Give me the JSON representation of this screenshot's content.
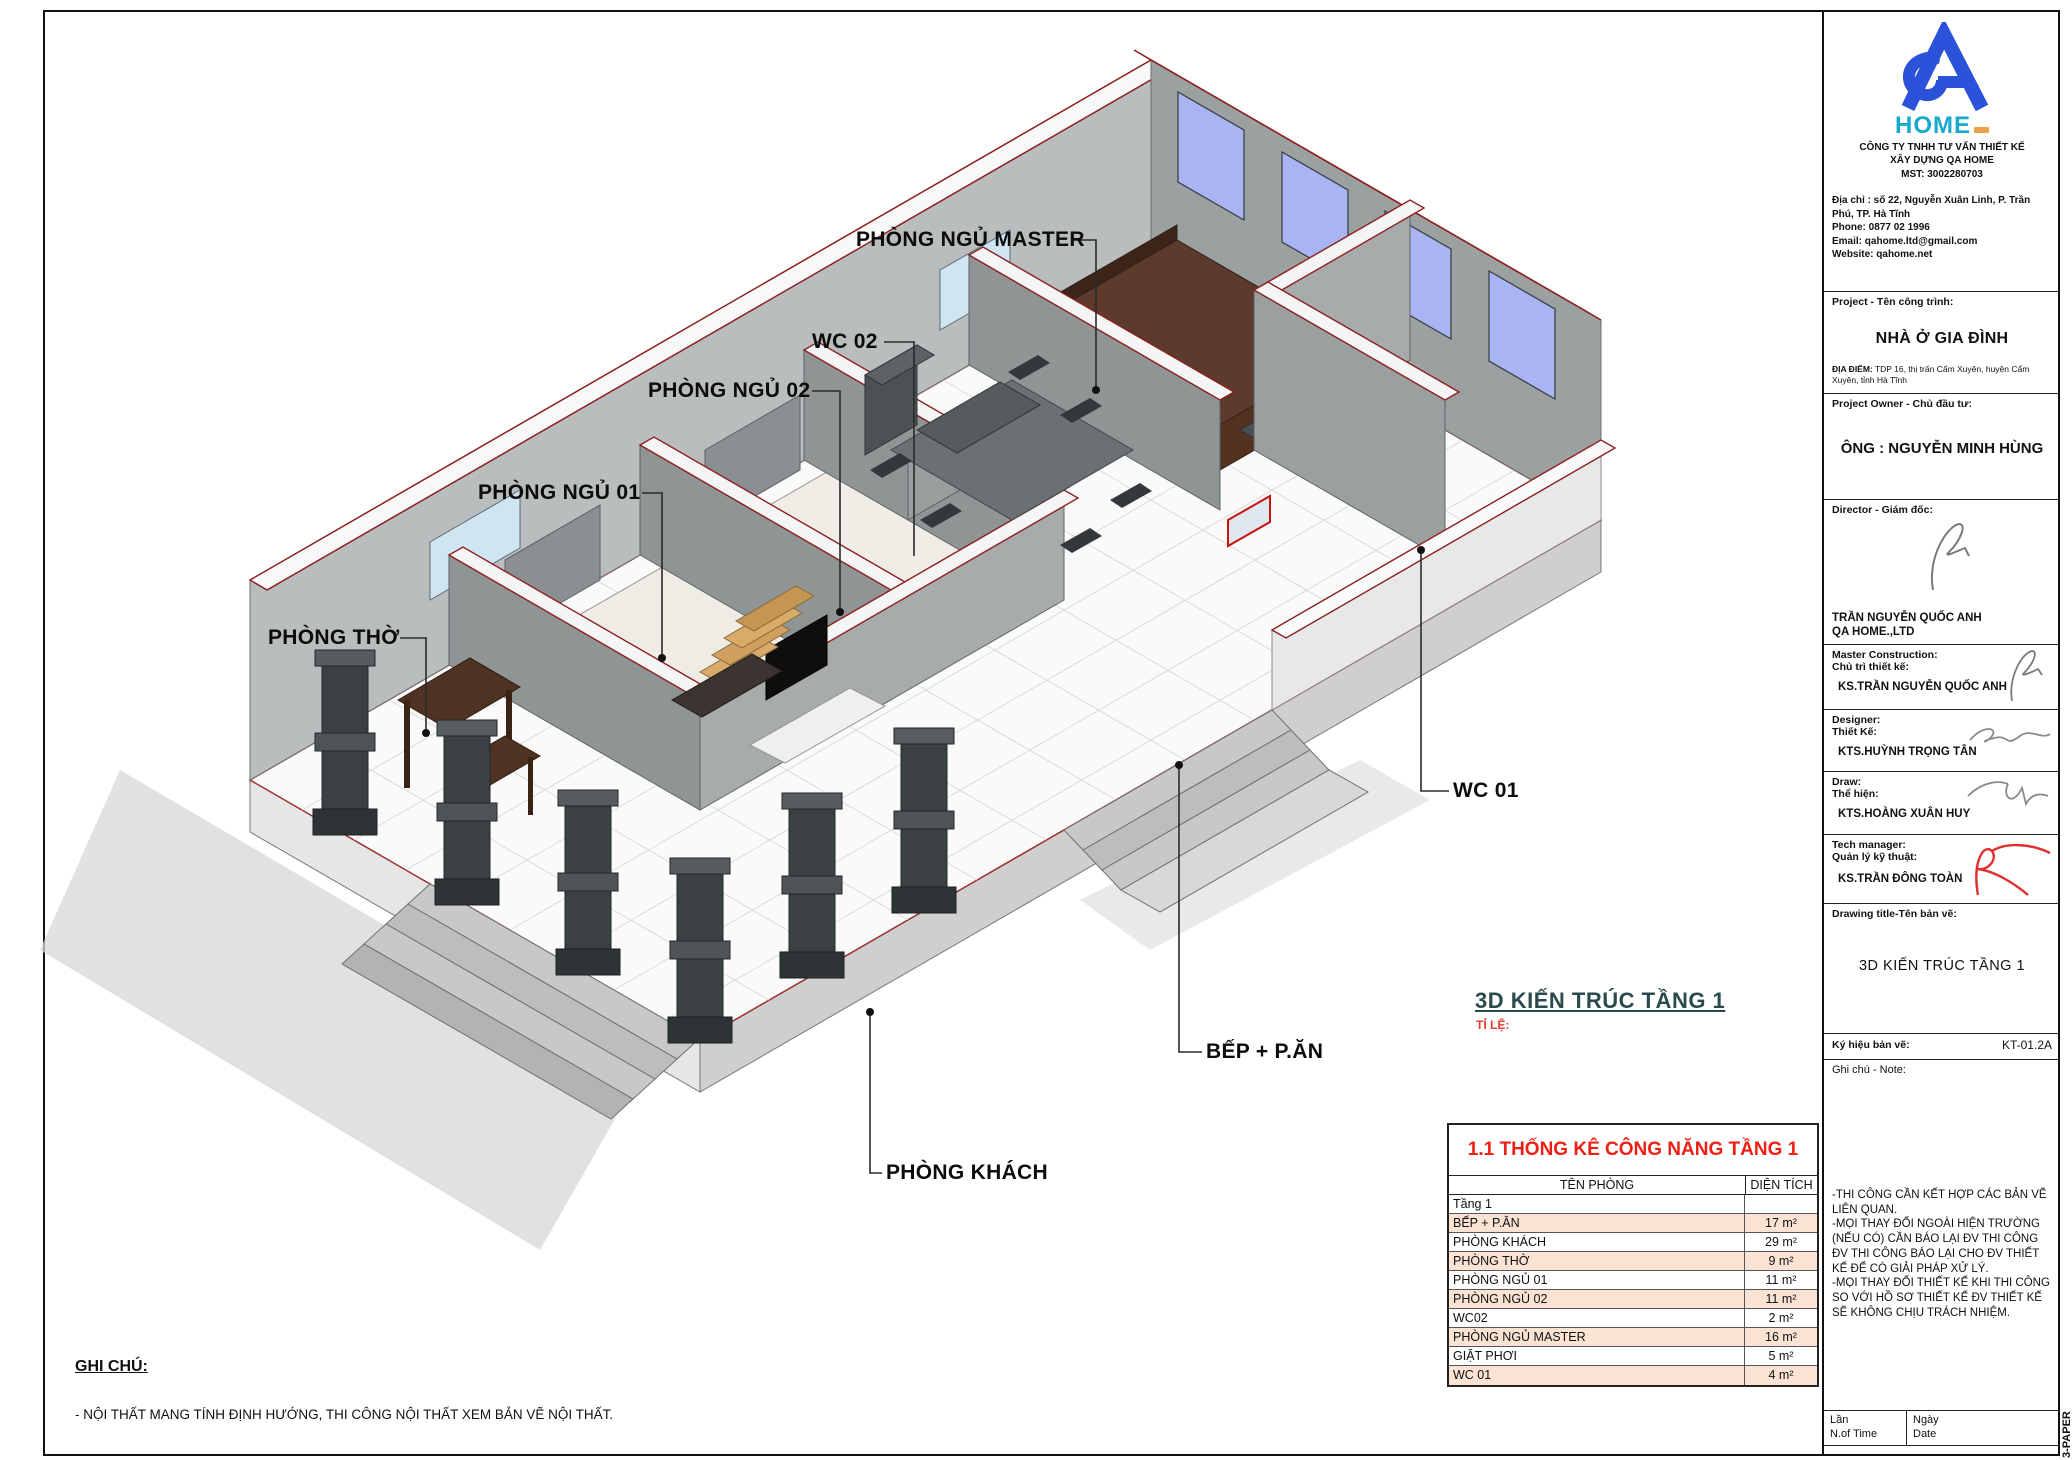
{
  "sheet": {
    "paper_label": "3-PAPER"
  },
  "logo": {
    "monogram": "QA",
    "home_text": "HOME"
  },
  "company": {
    "name_line1": "CÔNG TY TNHH TƯ VẤN THIẾT KẾ",
    "name_line2": "XÂY DỰNG QA HOME",
    "mst": "MST: 3002280703",
    "address": "Địa chỉ : số 22, Nguyễn Xuân Linh, P. Trần Phú, TP. Hà Tĩnh",
    "phone": "Phone: 0877 02 1996",
    "email": "Email: qahome.ltd@gmail.com",
    "website": "Website: qahome.net"
  },
  "project": {
    "label": "Project - Tên công trình:",
    "name": "NHÀ Ở GIA ĐÌNH",
    "location_label": "ĐỊA ĐIỂM:",
    "location": " TDP 16, thị trấn Cẩm Xuyên, huyện Cẩm Xuyên, tỉnh Hà Tĩnh"
  },
  "owner": {
    "label": "Project Owner - Chủ đầu tư:",
    "name": "ÔNG : NGUYỄN MINH HÙNG"
  },
  "director": {
    "label": "Director - Giám đốc:",
    "name": "TRẦN NGUYỄN QUỐC ANH",
    "company": "QA HOME.,LTD"
  },
  "master_construction": {
    "label_en": "Master Construction:",
    "label_vi": "Chủ trì thiết kế:",
    "name": "KS.TRẦN NGUYỄN QUỐC ANH"
  },
  "designer": {
    "label_en": "Designer:",
    "label_vi": "Thiết Kế:",
    "name": "KTS.HUỲNH TRỌNG TÂN"
  },
  "draw": {
    "label_en": "Draw:",
    "label_vi": "Thể hiện:",
    "name": "KTS.HOÀNG XUÂN HUY"
  },
  "tech_manager": {
    "label_en": "Tech manager:",
    "label_vi": "Quản lý kỹ thuật:",
    "name": "KS.TRẦN ĐÔNG TOÀN"
  },
  "drawing": {
    "title_label": "Drawing title-Tên bản vẽ:",
    "title": "3D KIẾN TRÚC TẦNG 1",
    "symbol_label": "Ký hiệu bản vẽ:",
    "symbol": "KT-01.2A",
    "note_label": "Ghi chú - Note:"
  },
  "side_note": {
    "lines": [
      "-THI CÔNG CẦN KẾT HỢP CÁC BẢN VẼ LIÊN QUAN.",
      "-MỌI THAY ĐỔI NGOÀI HIỆN TRƯỜNG (NẾU CÓ) CẦN BÁO LẠI ĐV THI CÔNG ĐV THI CÔNG BÁO LẠI CHO ĐV THIẾT KẾ ĐỂ CÓ GIẢI PHÁP XỬ LÝ.",
      "-MỌI THAY ĐỔI THIẾT KẾ KHI THI CÔNG SO VỚI HỒ SƠ THIẾT KẾ ĐV THIẾT KẾ SẼ KHÔNG CHỊU TRÁCH NHIỆM."
    ]
  },
  "view": {
    "title": "3D KIẾN TRÚC TẦNG 1",
    "scale_label": "TỈ LỆ:"
  },
  "room_labels": {
    "master": "PHÒNG NGỦ MASTER",
    "wc02": "WC 02",
    "ngu02": "PHÒNG NGỦ 02",
    "ngu01": "PHÒNG NGỦ 01",
    "tho": "PHÒNG THỜ",
    "wc01": "WC 01",
    "bep": "BẾP + P.ĂN",
    "khach": "PHÒNG KHÁCH"
  },
  "stats_table": {
    "title": "1.1 THỐNG KÊ CÔNG NĂNG TẦNG 1",
    "col_name": "TÊN PHÒNG",
    "col_area": "DIỆN TÍCH",
    "group": "Tầng 1",
    "rows": [
      [
        "BẾP + P.ĂN",
        "17 m²"
      ],
      [
        "PHÒNG KHÁCH",
        "29 m²"
      ],
      [
        "PHÒNG THỜ",
        "9 m²"
      ],
      [
        "PHÒNG NGỦ 01",
        "11 m²"
      ],
      [
        "PHÒNG NGỦ 02",
        "11 m²"
      ],
      [
        "WC02",
        "2 m²"
      ],
      [
        "PHÒNG NGỦ MASTER",
        "16 m²"
      ],
      [
        "GIẶT PHƠI",
        "5 m²"
      ],
      [
        "WC 01",
        "4 m²"
      ]
    ]
  },
  "revision": {
    "lan": "Lần",
    "n_of_time": "N.of Time",
    "ngay": "Ngày",
    "date": "Date"
  },
  "ghi_chu": {
    "heading": "GHI CHÚ:",
    "body": "- NỘI THẤT MANG TÍNH ĐỊNH HƯỚNG, THI CÔNG NỘI THẤT XEM BẢN VẼ NỘI THẤT."
  },
  "colors": {
    "brand_blue": "#2b52d8",
    "brand_teal": "#17aacc",
    "accent_red": "#ee2016",
    "table_stripe": "#fbe3d4",
    "view_title_teal": "#2b4a4d",
    "wall_outline_red": "#8b2020"
  }
}
